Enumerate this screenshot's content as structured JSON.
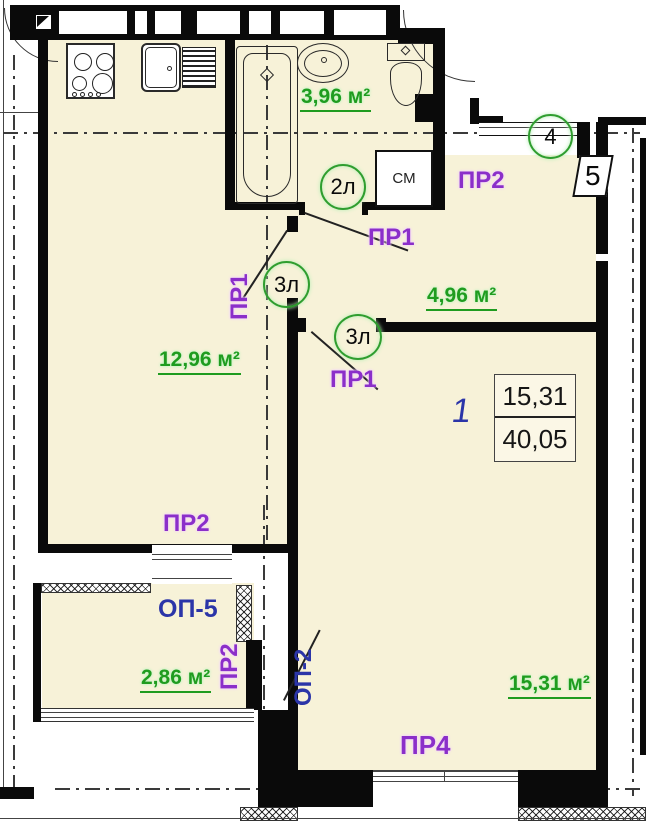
{
  "colors": {
    "floor_fill": "#f7f2d8",
    "wall": "#000000",
    "area_label_green": "#1f9c1f",
    "door_label_purple": "#8b2fc9",
    "window_label_blue": "#2b35a8",
    "door_mark_green": "#2f9e2f"
  },
  "areas": {
    "bathroom": "3,96 м²",
    "hallway": "4,96 м²",
    "kitchen": "12,96 м²",
    "balcony": "2,86 м²",
    "living_room": "15,31 м²"
  },
  "summary": {
    "apartment_number": "1",
    "living_area": "15,31",
    "total_area": "40,05"
  },
  "labels": {
    "pr1": "ПР1",
    "pr2": "ПР2",
    "pr4": "ПР4",
    "op5": "ОП-5",
    "op2": "ОП-2",
    "door_2l": "2л",
    "door_3l": "3л",
    "entrance_mark": "4",
    "wall_mark": "5",
    "washing_machine": "СМ"
  }
}
